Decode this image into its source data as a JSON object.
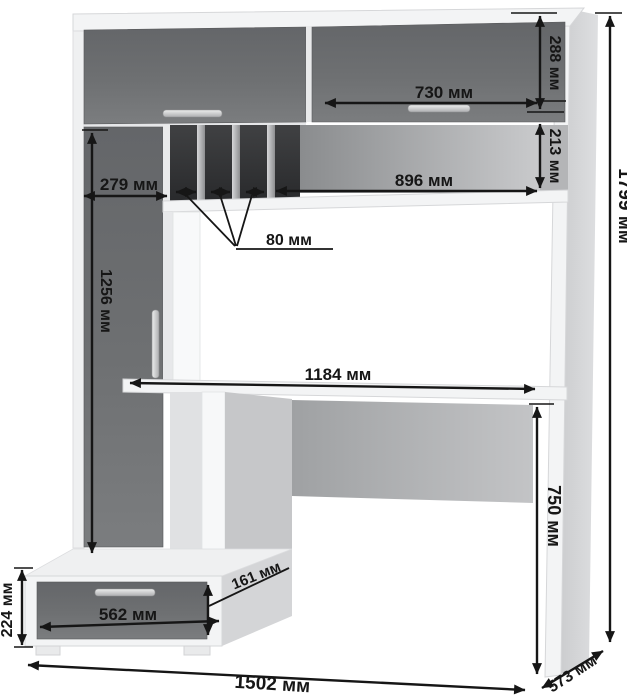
{
  "diagram": {
    "kind": "furniture-assembly-dimension-drawing",
    "subject": "computer desk with hutch, tall cabinet and drawer pedestal",
    "unit": "мм",
    "labels": {
      "d288": "288 мм",
      "d730": "730 мм",
      "d213": "213 мм",
      "d896": "896 мм",
      "d279": "279 мм",
      "d80": "80 мм",
      "d1256": "1256 мм",
      "d1184": "1184 мм",
      "d750": "750 мм",
      "d1799": "1799 мм",
      "d224": "224 мм",
      "d562": "562 мм",
      "d161": "161 мм",
      "d1502": "1502 мм",
      "d573": "573 мм"
    },
    "dimensions_mm": {
      "overall_height": 1799,
      "overall_width": 1502,
      "desk_depth": 573,
      "upper_door_height": 288,
      "upper_right_door_width": 730,
      "open_shelf_height": 213,
      "open_shelf_width": 896,
      "left_cabinet_width": 279,
      "pigeonhole_slot_width": 80,
      "tall_door_height": 1256,
      "desktop_width": 1184,
      "desk_height_from_floor": 750,
      "drawer_pedestal_height": 224,
      "drawer_width": 562,
      "drawer_front_height": 161
    },
    "colors": {
      "background": "#ffffff",
      "door_gray": "#6b6d6f",
      "panel_white": "#f3f4f5",
      "dimension_ink": "#161616"
    }
  }
}
